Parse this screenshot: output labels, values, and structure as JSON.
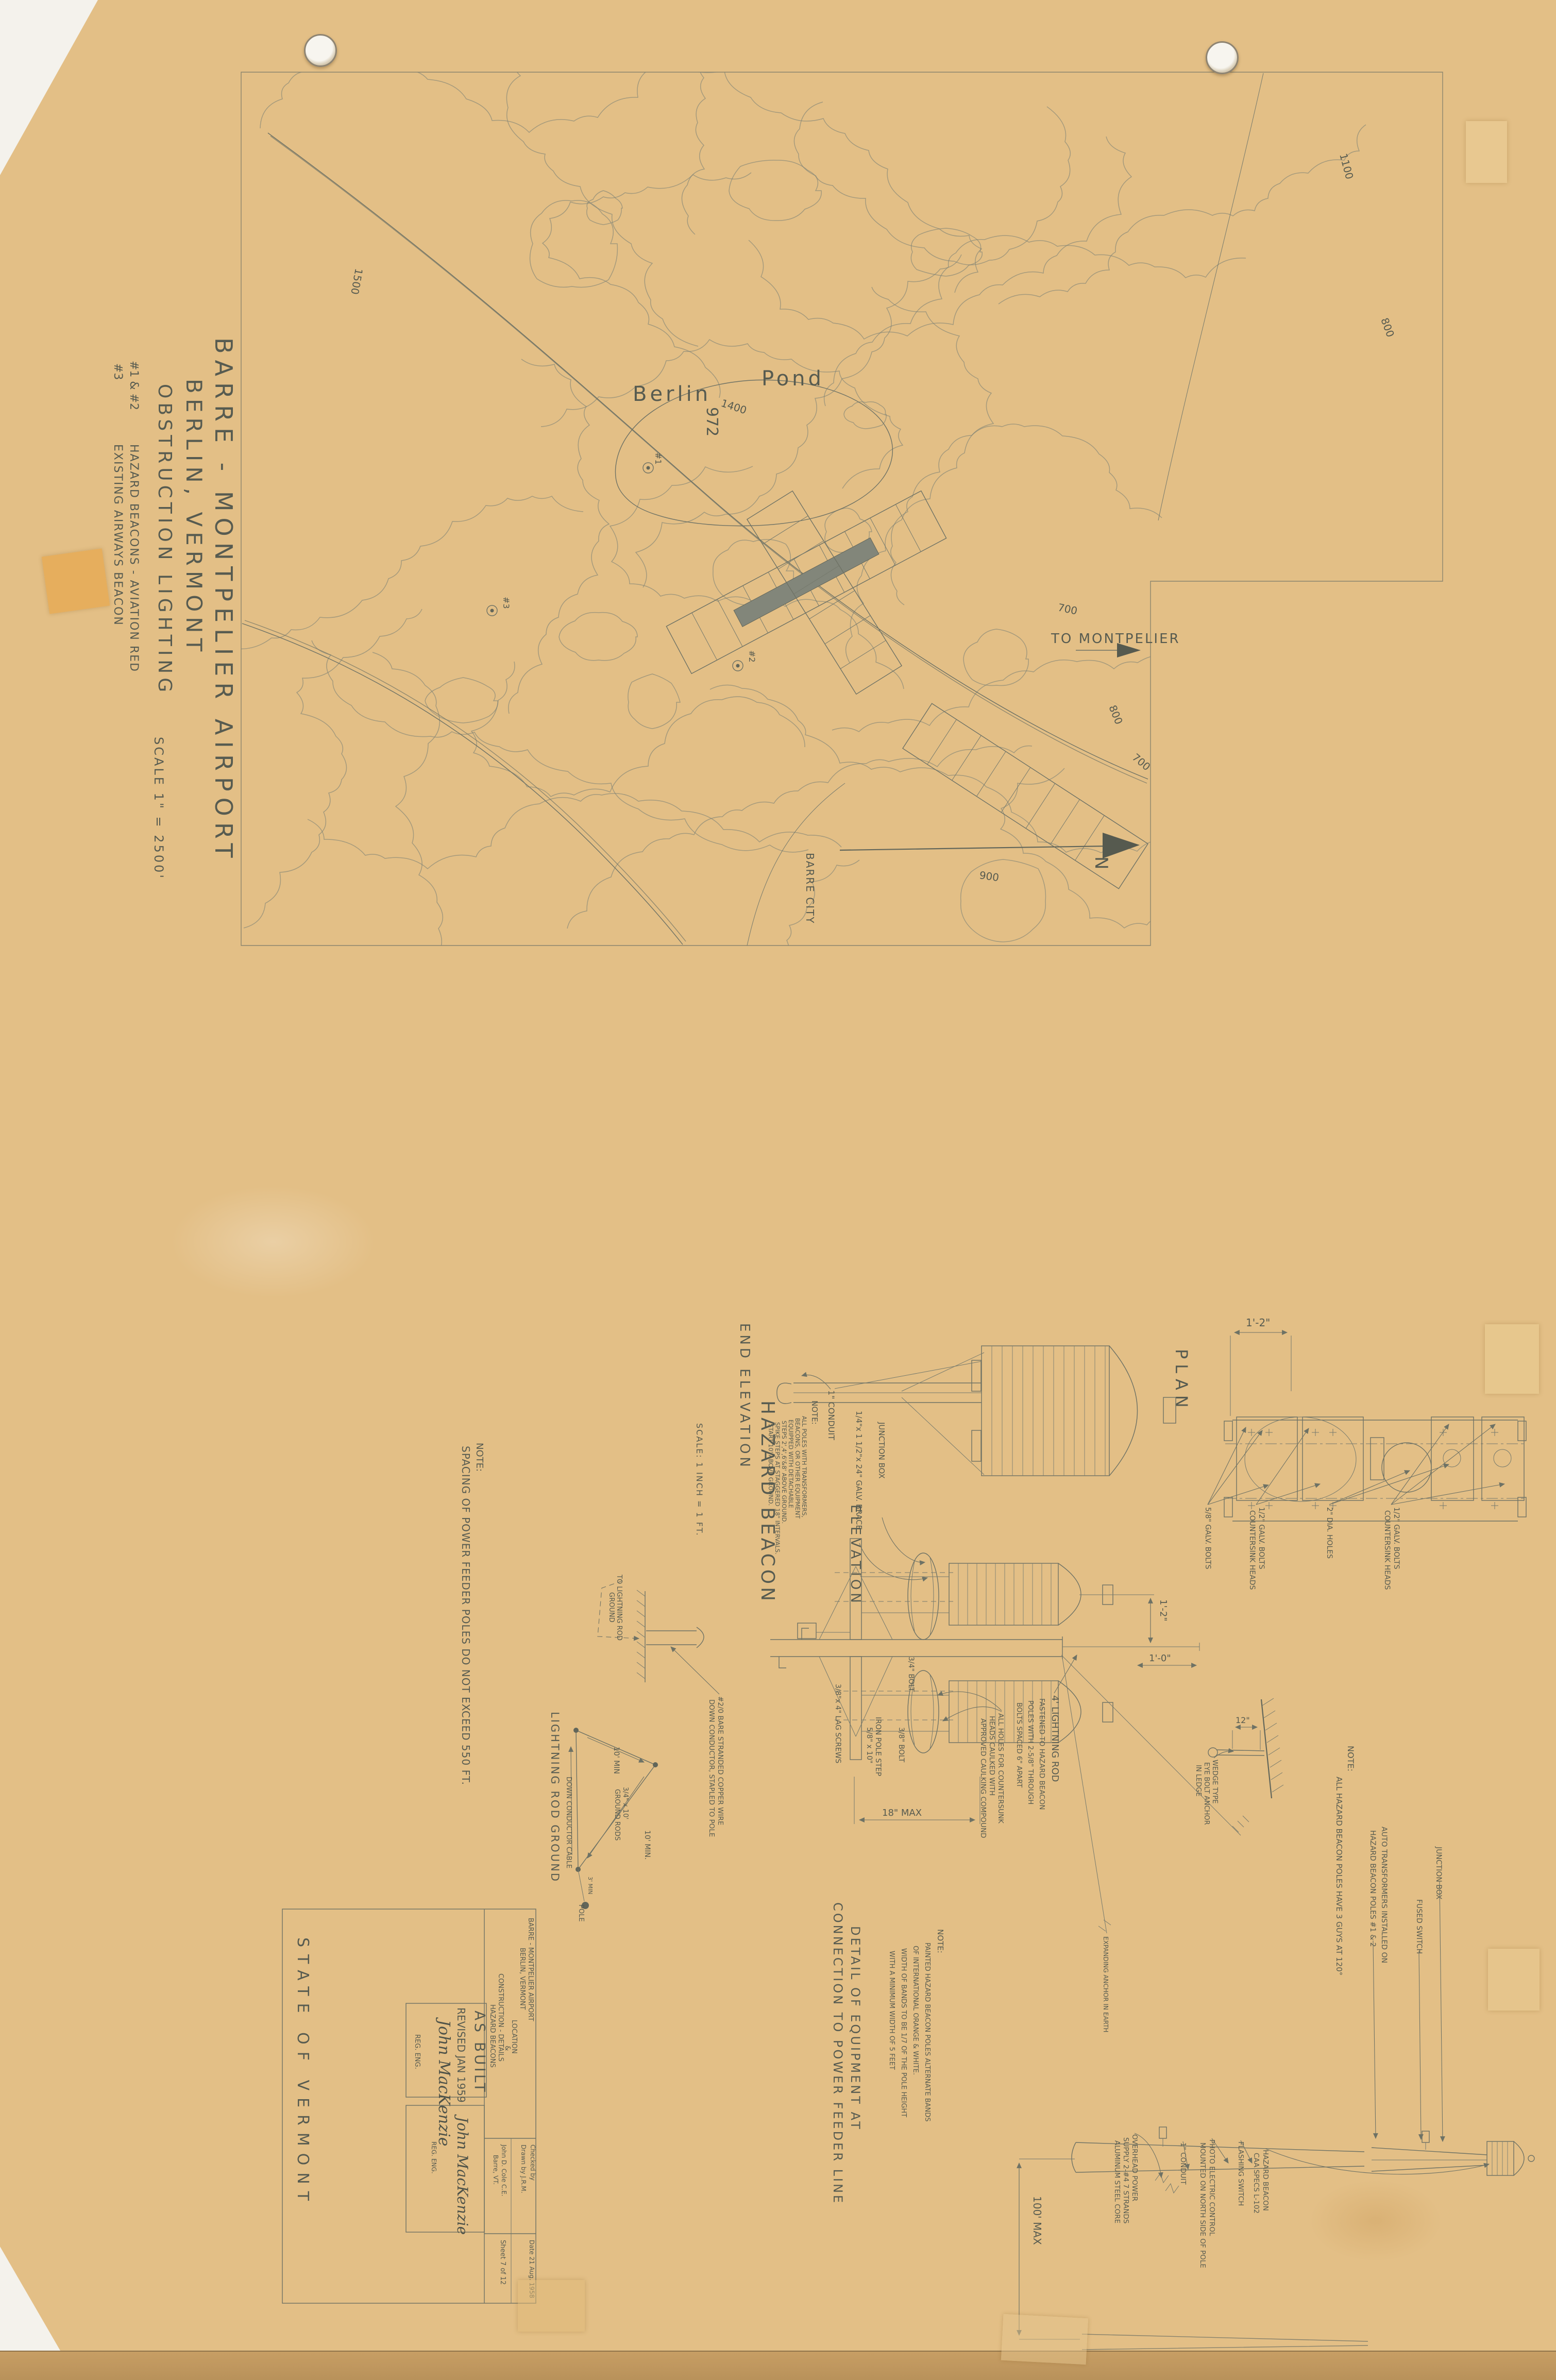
{
  "side": {
    "title1": "BARRE - MONTPELIER AIRPORT",
    "title2": "BERLIN, VERMONT",
    "title3": "OBSTRUCTION LIGHTING",
    "legend1_sym": "#1 & #2",
    "legend1": "HAZARD BEACONS - AVIATION RED",
    "legend2_sym": "#3",
    "legend2": "EXISTING AIRWAYS BEACON",
    "scale": "SCALE  1\" = 2500'"
  },
  "map": {
    "berlin": "Berlin",
    "pond": "Pond",
    "pond_elev": "972",
    "to_montpelier": "TO MONTPELIER",
    "barre_city": "BARRE CITY",
    "north": "N",
    "contour_labels": [
      "1400",
      "1100",
      "800",
      "700",
      "800",
      "700",
      "900",
      "1500"
    ],
    "beacon_1": "#1",
    "beacon_2": "#2",
    "beacon_3": "#3"
  },
  "views": {
    "end_elevation": "END ELEVATION",
    "hazard_beacon": "HAZARD BEACON",
    "beacon_scale": "SCALE: 1 INCH = 1 FT.",
    "elevation": "ELEVATION",
    "plan": "PLAN"
  },
  "plan": {
    "dim": "1'-2\"",
    "c1": "5/8\" GALV. BOLTS",
    "c2a": "1/2\" GALV. BOLTS",
    "c2b": "COUNTERSINK HEADS",
    "c3": "2\" DIA. HOLES",
    "c4a": "1/2\" GALV. BOLTS",
    "c4b": "COUNTERSINK HEADS"
  },
  "elev": {
    "conduit": "1\" CONDUIT",
    "brace": "1/4\"x 1 1/2\"x 24\" GALV. BRACE",
    "junction": "JUNCTION BOX",
    "lag": "3/8\"x 4\" LAG SCREWS",
    "step1": "IRON POLE STEP",
    "step2": "5/8\" x 10\"",
    "bolt38": "3/8\" BOLT",
    "bolt34": "3/4\" BOLT",
    "dim18": "18\" MAX",
    "dim12": "1'-2\"",
    "dim10": "1'-0\"",
    "rod1": "4' LIGHTNING ROD",
    "rod2": "FASTENED TO HAZARD BEACON",
    "rod3": "POLES WITH 2-5/8\" THROUGH",
    "rod4": "BOLTS SPACED 6\" APART",
    "caulk1": "ALL HOLES FOR COUNTERSUNK",
    "caulk2": "HEADS CAULKED WITH",
    "caulk3": "APPROVED CAULKING COMPOUND",
    "anchor_earth": "EXPANDING ANCHOR IN EARTH"
  },
  "lightning": {
    "to1": "TO LIGHTNING ROD",
    "to2": "GROUND",
    "dc1": "#2/0 BARE STRANDED COPPER WIRE",
    "dc2": "DOWN CONDUCTOR, STAPLED TO POLE",
    "title": "LIGHTNING ROD GROUND",
    "d1": "10' MIN",
    "d2": "3/4\" x 10'",
    "d3": "GROUND RODS",
    "d4": "DOWN CONDUCTOR CABLE",
    "d5": "10' MIN.",
    "d6": "3' MIN",
    "d7": "POLE"
  },
  "wedge": {
    "dim": "12\"",
    "l1": "WEDGE TYPE",
    "l2": "EYE BOLT ANCHOR",
    "l3": "IN LEDGE"
  },
  "power": {
    "title1": "DETAIL OF EQUIPMENT AT",
    "title2": "CONNECTION TO POWER FEEDER LINE",
    "dim100": "100' MAX",
    "supply1": "OVERHEAD POWER",
    "supply2": "SUPPLY 2-#4 7 STRANDS",
    "supply3": "ALUMINUM STEEL CORE",
    "conduit": "1\" CONDUIT",
    "photo1": "PHOTO ELECTRIC CONTROL",
    "photo2": "MOUNTED ON NORTH SIDE OF POLE",
    "flashing": "FLASHING SWITCH",
    "beacon1": "HAZARD BEACON",
    "beacon2": "CAA SPECS L-102",
    "fused": "FUSED SWITCH",
    "junction": "JUNCTION BOX"
  },
  "notes": {
    "steps": {
      "head": "NOTE:",
      "l1": "ALL POLES WITH TRANSFORMERS,",
      "l2": "BEACONS, OR OTHER EQUIPMENT",
      "l3": "EQUIPPED WITH DETACHABLE",
      "l4": "STEPS 2',4',6'&8' ABOVE GROUND.",
      "l5": "SPIKE STEPS AT STAGGERED 18\" INTERVALS.",
      "l6": "START 10' ABOVE GROUND."
    },
    "feeder": {
      "head": "NOTE:",
      "line": "SPACING OF POWER FEEDER POLES DO NOT EXCEED 550 FT."
    },
    "guys": {
      "head": "NOTE:",
      "line": "ALL HAZARD BEACON POLES HAVE 3 GUYS AT 120°"
    },
    "transformers": {
      "l1": "AUTO TRANSFORMERS INSTALLED ON",
      "l2": "HAZARD BEACON POLES #1 & 2"
    },
    "paint": {
      "head": "NOTE:",
      "l1": "PAINTED HAZARD BEACON POLES ALTERNATE BANDS",
      "l2": "OF INTERNATIONAL ORANGE & WHITE.",
      "l3": "WIDTH OF BANDS TO BE 1/7 OF THE POLE HEIGHT",
      "l4": "WITH A MINIMUM WIDTH OF 5 FEET"
    }
  },
  "titleblock": {
    "state": "STATE OF VERMONT",
    "l2": "BARRE - MONTPELIER AIRPORT",
    "l3": "BERLIN, VERMONT",
    "l4": "LOCATION",
    "amp": "&",
    "l5": "CONSTRUCTION - DETAILS",
    "l6": "HAZARD BEACONS",
    "firm": "John D. Cole C.E.",
    "firm2": "Barre, VT.",
    "checked": "Checked by",
    "drawn": "Drawn by J.R.M.",
    "date": "Date 21 Aug. 1958",
    "sheetno": "Sheet 7 of 12"
  },
  "stamp": {
    "l1": "AS BUILT",
    "l2": "REVISED JAN 1959",
    "sig": "John MacKenzie",
    "reg": "REG. ENG.",
    "sig2": "John MacKenzie",
    "reg2": "REG. ENG."
  }
}
